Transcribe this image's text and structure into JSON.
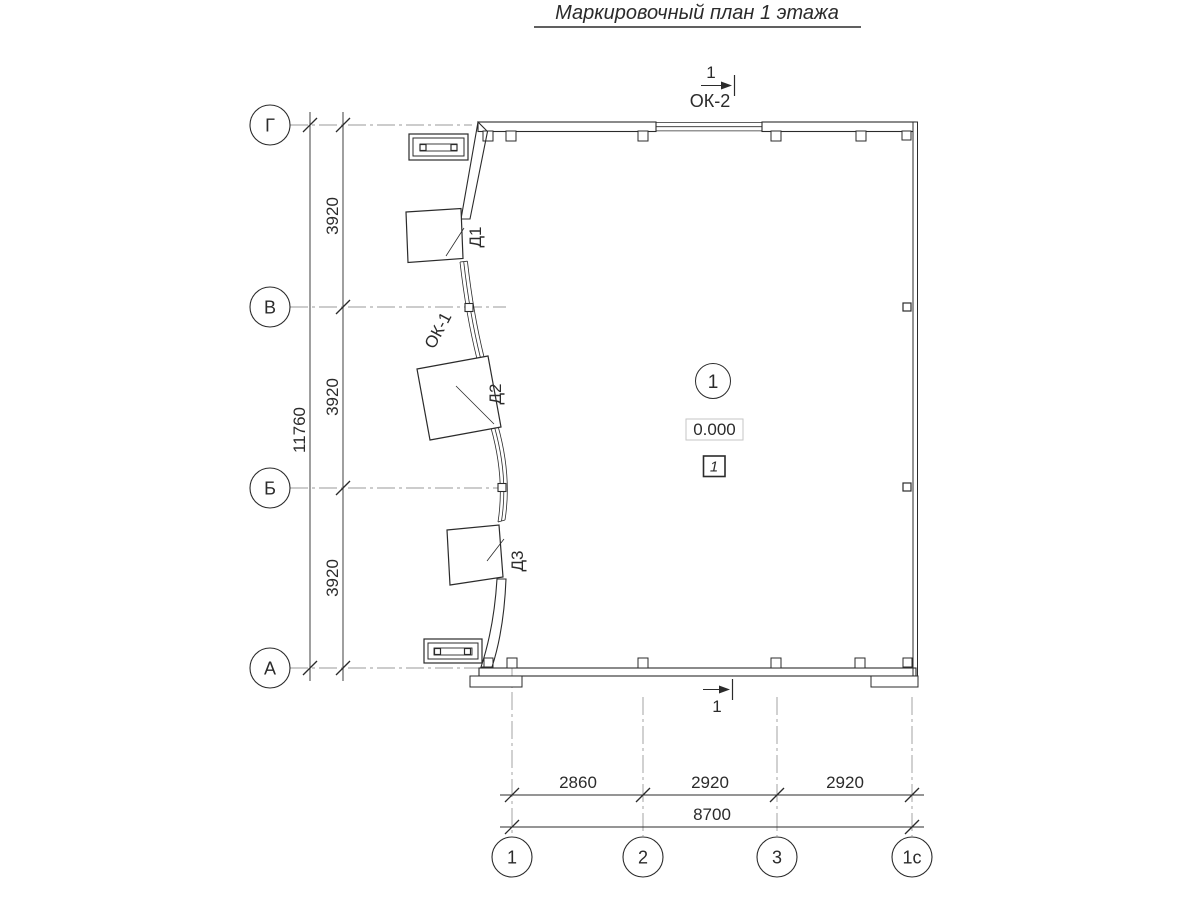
{
  "title": "Маркировочный план 1 этажа",
  "axes": {
    "rows": [
      {
        "label": "Г"
      },
      {
        "label": "В"
      },
      {
        "label": "Б"
      },
      {
        "label": "А"
      }
    ],
    "cols": [
      {
        "label": "1"
      },
      {
        "label": "2"
      },
      {
        "label": "3"
      },
      {
        "label": "1с"
      }
    ]
  },
  "dimensions": {
    "row_spacing": [
      "3920",
      "3920",
      "3920"
    ],
    "row_total": "11760",
    "col_spacing": [
      "2860",
      "2920",
      "2920"
    ],
    "col_total": "8700"
  },
  "openings": {
    "doors": [
      {
        "label": "Д1"
      },
      {
        "label": "Д2"
      },
      {
        "label": "Д3"
      }
    ],
    "window_left": "ОК-1",
    "window_top": "ОК-2"
  },
  "room": {
    "number": "1",
    "elevation": "0.000",
    "floor_type": "1"
  },
  "section": {
    "top_label": "1",
    "bottom_label": "1"
  },
  "colors": {
    "line": "#2b2b2b",
    "axis_line": "#9a9a9a",
    "elevation_box": "#c6c6c6"
  }
}
